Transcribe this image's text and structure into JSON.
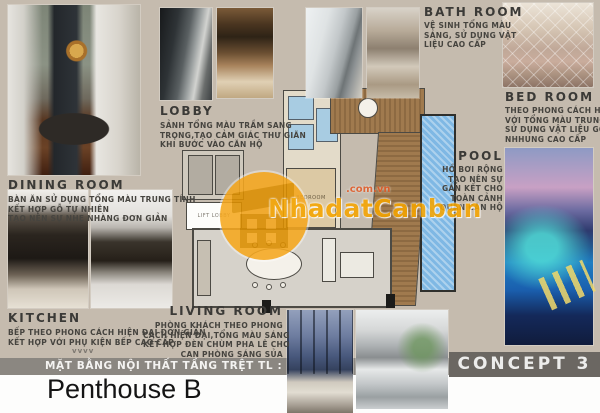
{
  "colors": {
    "background": "#c5bbae",
    "plan_bar": "#8b8781",
    "concept_bar": "#6b6762",
    "watermark_orange": "#f6a500",
    "pool_blue": "#7fb8e4",
    "bath_blue": "#a8cce2",
    "deck_wood": "#9b7a4e"
  },
  "watermark": {
    "brand": "NhadatCanban",
    "domain": ".com.vn"
  },
  "sections": {
    "dining": {
      "title": "DINING ROOM",
      "lines": [
        "BÀN ĂN SỬ DỤNG TỔNG MÀU TRUNG TÍNH",
        "KẾT HỢP GỖ TỰ NHIÊN",
        "TẠO NÊN SỰ NHẸ NHÀNG ĐƠN GIẢN"
      ]
    },
    "lobby": {
      "title": "LOBBY",
      "lines": [
        "SẢNH TỔNG MÀU TRẦM SANG",
        "TRỌNG,TẠO CẢM GIÁC THƯ GIÃN",
        "KHI BƯỚC VÀO CĂN HỘ"
      ]
    },
    "bath": {
      "title": "BATH ROOM",
      "lines": [
        "VỆ SINH TỔNG MÀU",
        "SÁNG, SỬ DỤNG VẬT",
        "LIỆU CAO CẤP"
      ]
    },
    "bed": {
      "title": "BED ROOM",
      "lines": [
        "THEO PHONG CÁCH HIỆN ĐẠI",
        "VỚI TỔNG MÀU TRUNG TÍNH,",
        "SỬ DỤNG VẬT LIỆU GỖ,",
        "NHHUNG CAO CẤP"
      ]
    },
    "pool": {
      "title": "POOL",
      "lines": [
        "HỒ BƠI RỘNG",
        "TẠO NÊN SỰ",
        "GẮN KẾT CHO",
        "TOÀN CẢNH",
        "QUAN CĂN HỘ"
      ]
    },
    "kitchen": {
      "title": "KITCHEN",
      "lines": [
        "BẾP THEO PHONG CÁCH HIỆN ĐẠI ĐƠN GIẢN",
        "KẾT HỢP VỚI PHỤ KIỆN BẾP CAO CẤP"
      ]
    },
    "living": {
      "title": "LIVING ROOM",
      "lines": [
        "PHÒNG KHÁCH THEO PHONG",
        "CÁCH HIỆN ĐẠI,TỔNG MÀU SÁNG",
        "KẾT HỢP ĐÈN CHÙM PHA LÊ CHO",
        "CAN PHÒNG SÁNG SỦA"
      ]
    }
  },
  "floor_plan": {
    "labels": {
      "bedroom": "BEDROOM",
      "lift_lobby": "LIFT LOBBY"
    }
  },
  "footer": {
    "plan_caption": "MẶT BẰNG NỘI THẤT TẦNG TRỆT TL : 1/100",
    "project": "Penthouse B",
    "concept": "CONCEPT 3",
    "decor": "vvvv"
  }
}
